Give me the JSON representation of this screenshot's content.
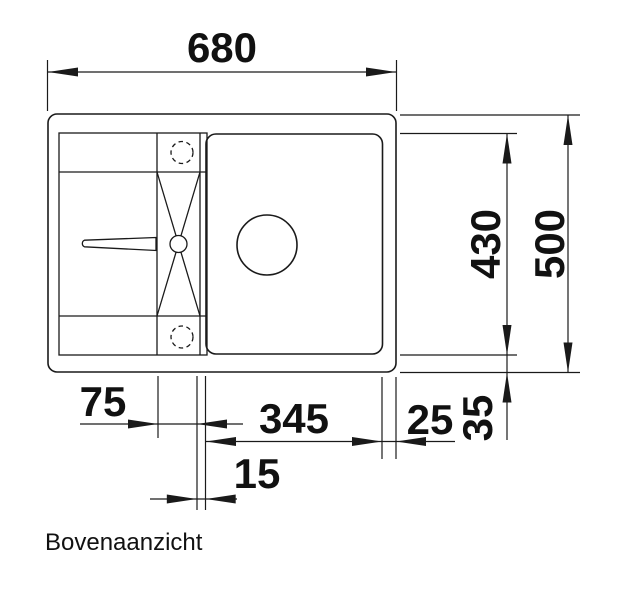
{
  "drawing": {
    "view_label": "Bovenaanzicht",
    "type": "sink-top-view-technical-drawing",
    "dimensions": {
      "overall_width": "680",
      "overall_depth": "500",
      "inner_depth": "430",
      "bowl_width": "345",
      "groove_section_width": "75",
      "divider_width": "15",
      "right_margin": "25",
      "bottom_margin": "35"
    },
    "colors": {
      "line": "#1a1a1a",
      "text": "#111111",
      "background": "#ffffff"
    }
  }
}
